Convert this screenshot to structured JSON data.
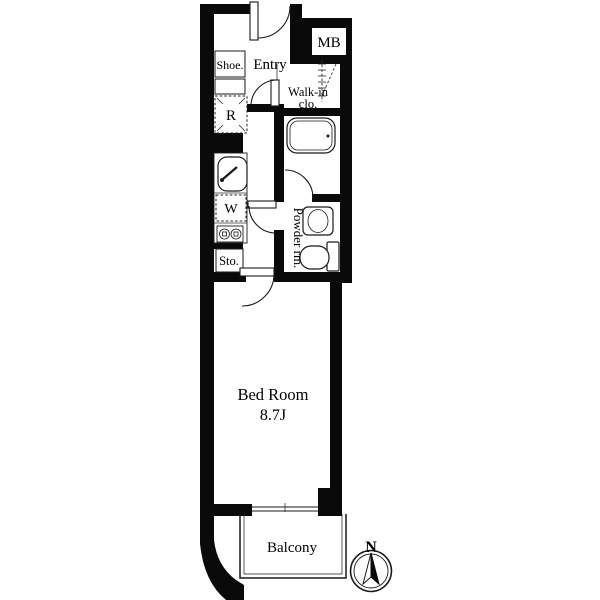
{
  "plan": {
    "labels": {
      "mb": "MB",
      "entry": "Entry",
      "shoe": "Shoe.",
      "fridge": "R",
      "walk_in_line1": "Walk-in",
      "walk_in_line2": "clo.",
      "washer": "W",
      "storage": "Sto.",
      "powder_room": "Powder rm.",
      "bedroom": "Bed Room",
      "bedroom_size": "8.7J",
      "balcony": "Balcony",
      "compass_north": "N"
    },
    "colors": {
      "wall": "#0a0a0a",
      "line": "#1a1a1a",
      "background": "#ffffff"
    }
  }
}
